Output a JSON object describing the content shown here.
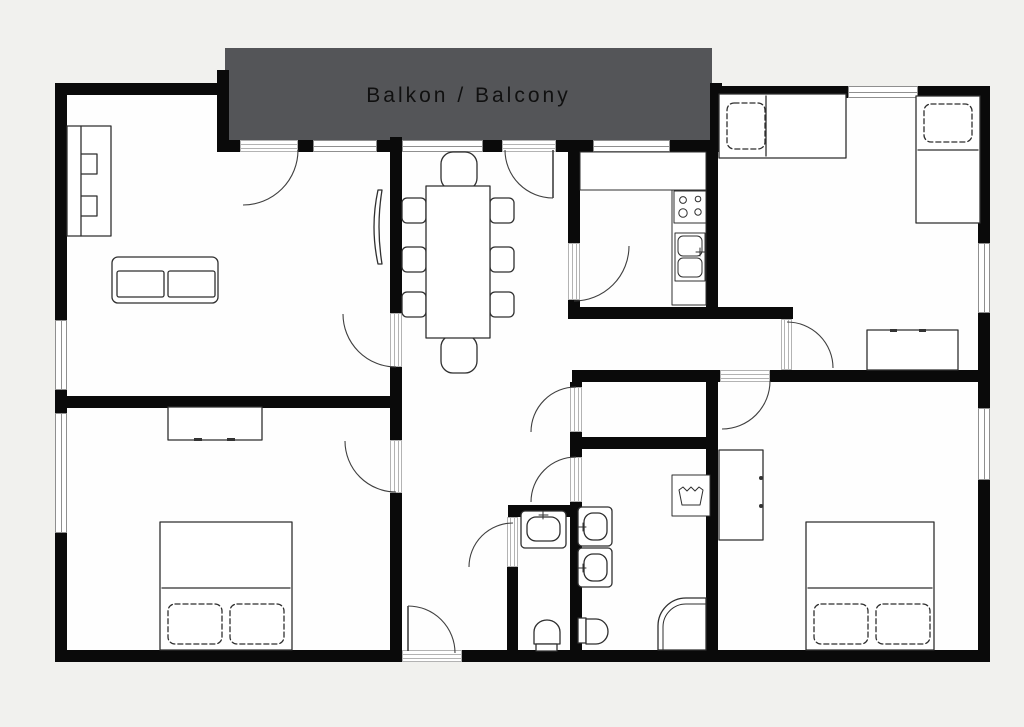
{
  "balcony": {
    "label": "Balkon / Balcony"
  },
  "colors": {
    "bg": "#f1f1ee",
    "floor": "#fefefe",
    "wall": "#0a0a0a",
    "balcony_fill": "#545558",
    "balcony_text": "#101010",
    "furniture": "#2f2f2f",
    "door": "#3f3f3f",
    "window_line": "#8f8f8f",
    "sill_line": "#b3b3b3"
  }
}
